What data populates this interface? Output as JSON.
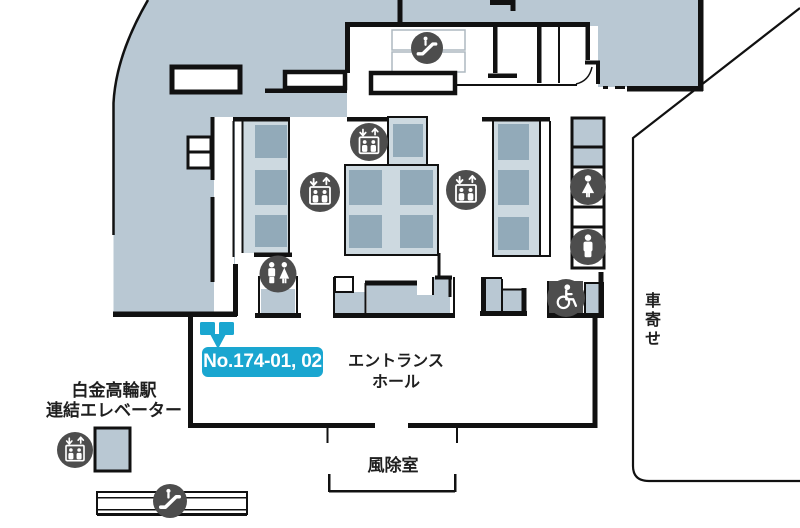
{
  "floor_plan": {
    "badge": {
      "label": "No.174-01, 02",
      "bg_color": "#1aa6d0",
      "text_color": "#ffffff"
    },
    "labels": {
      "entrance_hall": [
        "エントランス",
        "ホール"
      ],
      "vestibule": "風除室",
      "station_elevator": [
        "白金高輪駅",
        "連結エレベーター"
      ],
      "driveway": "車寄せ"
    },
    "icons": {
      "top_escalator": "escalator-icon",
      "bank_left_elevator": "elevator-icon",
      "bank_center_elevator": "elevator-icon",
      "bank_right_elevator": "elevator-icon",
      "multi_restroom": "mens-womens-restroom-icon",
      "womens_restroom": "womens-restroom-icon",
      "mens_restroom": "mens-restroom-icon",
      "accessible_restroom": "wheelchair-accessible-icon",
      "station_elevator": "elevator-icon",
      "station_escalator": "escalator-icon"
    },
    "colors": {
      "area_fill": "#b9c8d3",
      "bank_fill": "#cdd9e0",
      "unit_fill": "#92aab9",
      "icon_circle": "#4d4d4d",
      "wall": "#111111",
      "badge_cyan": "#1aa6d0"
    }
  }
}
